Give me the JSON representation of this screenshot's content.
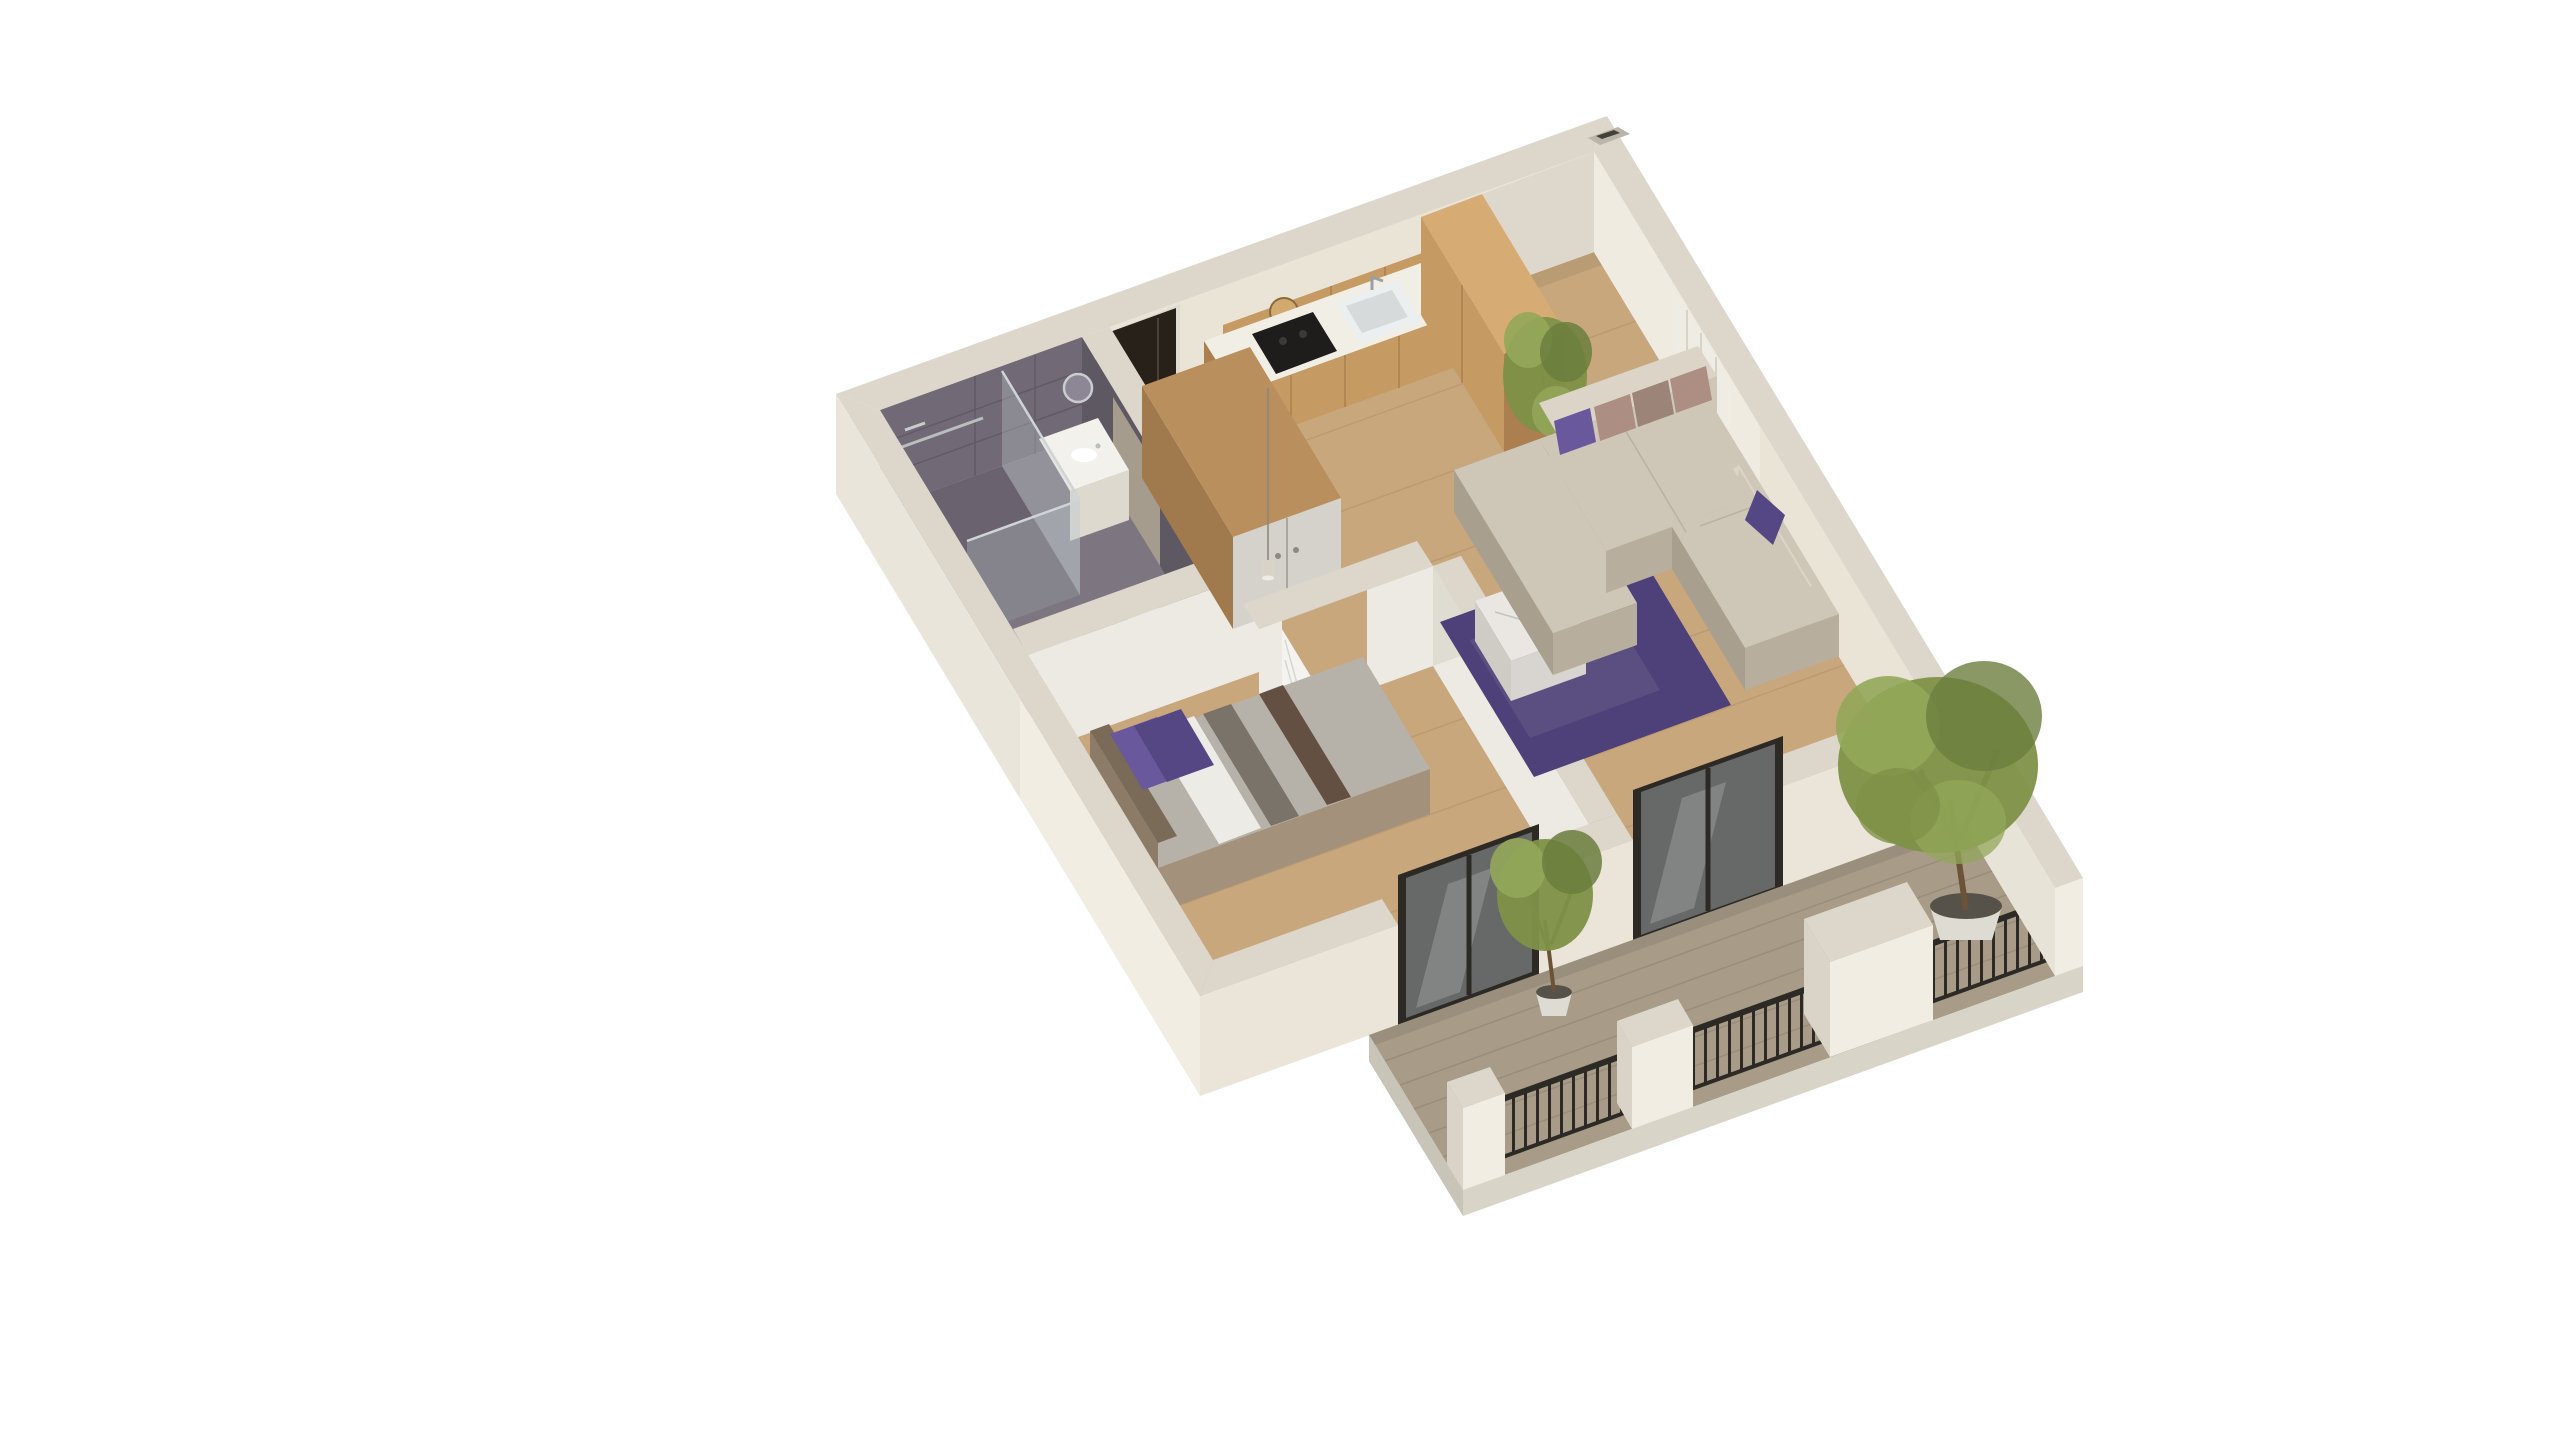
{
  "scene": {
    "type": "isometric-3d-floor-plan",
    "description": "3D cutaway render of a one-bedroom apartment with balcony on a white background",
    "background": "#ffffff",
    "rooms": [
      {
        "name": "bathroom",
        "finish": "dark stone tile",
        "items": [
          "glass-shower",
          "toilet",
          "vanity-sink",
          "round-mirror",
          "towel-rail",
          "bath-mat"
        ]
      },
      {
        "name": "hallway",
        "finish": "wood floor",
        "items": [
          "entry-door",
          "wardrobe",
          "pendant-light",
          "interior-door"
        ]
      },
      {
        "name": "kitchen",
        "finish": "wood floor",
        "items": [
          "base-cabinets",
          "upper-cabinets",
          "tall-cabinets",
          "countertop",
          "cooktop",
          "sink",
          "round-plate"
        ]
      },
      {
        "name": "living-room",
        "finish": "wood floor",
        "items": [
          "corner-sofa",
          "cushions",
          "area-rug",
          "marble-coffee-table",
          "radiator",
          "potted-plant"
        ]
      },
      {
        "name": "bedroom",
        "finish": "wood floor",
        "items": [
          "double-bed",
          "purple-pillows",
          "striped-duvet",
          "headboard"
        ]
      },
      {
        "name": "balcony",
        "finish": "decking",
        "items": [
          "black-metal-railing",
          "glass-door-bedroom",
          "glass-door-living",
          "large-tree",
          "small-tree",
          "parapet-wall"
        ]
      }
    ],
    "colors": {
      "wall_top": "#dcd7ca",
      "wall_outer": "#f2ede3",
      "wall_outer_front": "#ebe5d9",
      "wall_inner": "#eae4d7",
      "partition": "#eceae2",
      "partition_side": "#dfdcd2",
      "floor_wood": "#c8a77d",
      "floor_plank": "#b3926a",
      "bath_tile": "#716a76",
      "bath_tile_dark": "#5e5863",
      "bath_floor": "#7d7681",
      "shower_floor": "#6a636f",
      "kitchen_wood": "#c69a63",
      "kitchen_wood_dark": "#ab7f4f",
      "kitchen_wood_top": "#d7ac74",
      "counter": "#f1eee6",
      "cooktop": "#1e1d1b",
      "sofa": "#cec6b7",
      "sofa_dark": "#b7ae9d",
      "rug": "#4e4078",
      "pillow_purple": "#6a589d",
      "pillow_purple_dark": "#554784",
      "pillow_mauve": "#ac8e83",
      "pillow_taupe": "#9c8578",
      "bed_gray": "#b7b2a9",
      "bed_white": "#edebe6",
      "bed_stripe": "#6f675f",
      "bed_brown": "#5b4437",
      "bed_frame": "#a3917b",
      "bed_frame_dark": "#8c7b67",
      "marble": "#eae7e2",
      "marble_side": "#d8d5d0",
      "wardrobe_wood": "#b98f5e",
      "wardrobe_wood_dark": "#a07a4c",
      "wardrobe_door": "#d5d2cb",
      "door_white": "#f4f3ef",
      "door_handle_green": "#2e4a32",
      "entry_door": "#282119",
      "frame_black": "#2d2a26",
      "glass": "#aeb6ba",
      "deck": "#a89c88",
      "deck_plank": "#8f markdown847",
      "slab": "#d8d4c8",
      "foliage": "#7e9147",
      "foliage_light": "#93a75a",
      "foliage_dark": "#6b7e3d",
      "trunk": "#6c5337",
      "pot_white": "#dedbd2",
      "pot_soil": "#56524a",
      "radiator": "#efece3",
      "chrome": "#b9bec0",
      "vent_hole": "#44403a"
    }
  }
}
